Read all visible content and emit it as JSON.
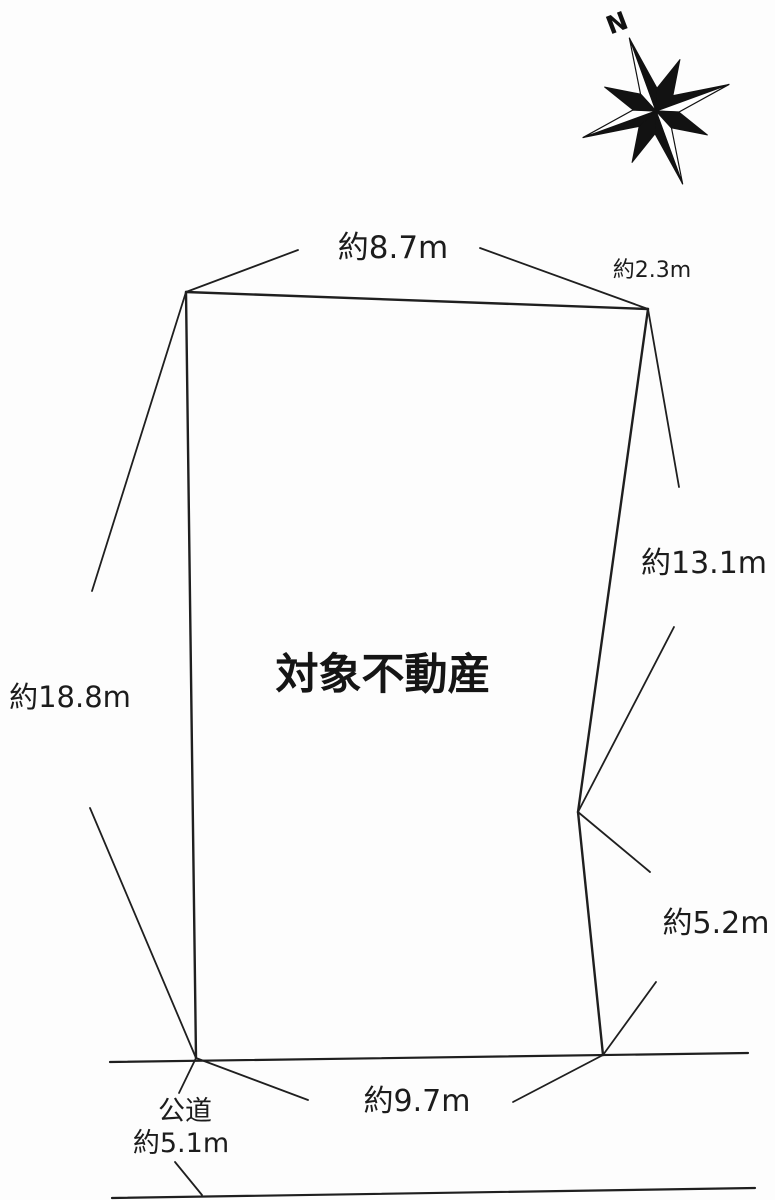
{
  "page": {
    "background": "#fdfdfd",
    "line_color": "#1f1f1f"
  },
  "diagram": {
    "title": "対象不動産",
    "compass": {
      "north_label": "N"
    },
    "labels": {
      "top_edge": "約8.7m",
      "top_right_edge": "約2.3m",
      "right_upper_edge": "約13.1m",
      "right_lower_edge": "約5.2m",
      "bottom_edge": "約9.7m",
      "left_edge": "約18.8m",
      "road_type": "公道",
      "road_width": "約5.1m"
    }
  }
}
